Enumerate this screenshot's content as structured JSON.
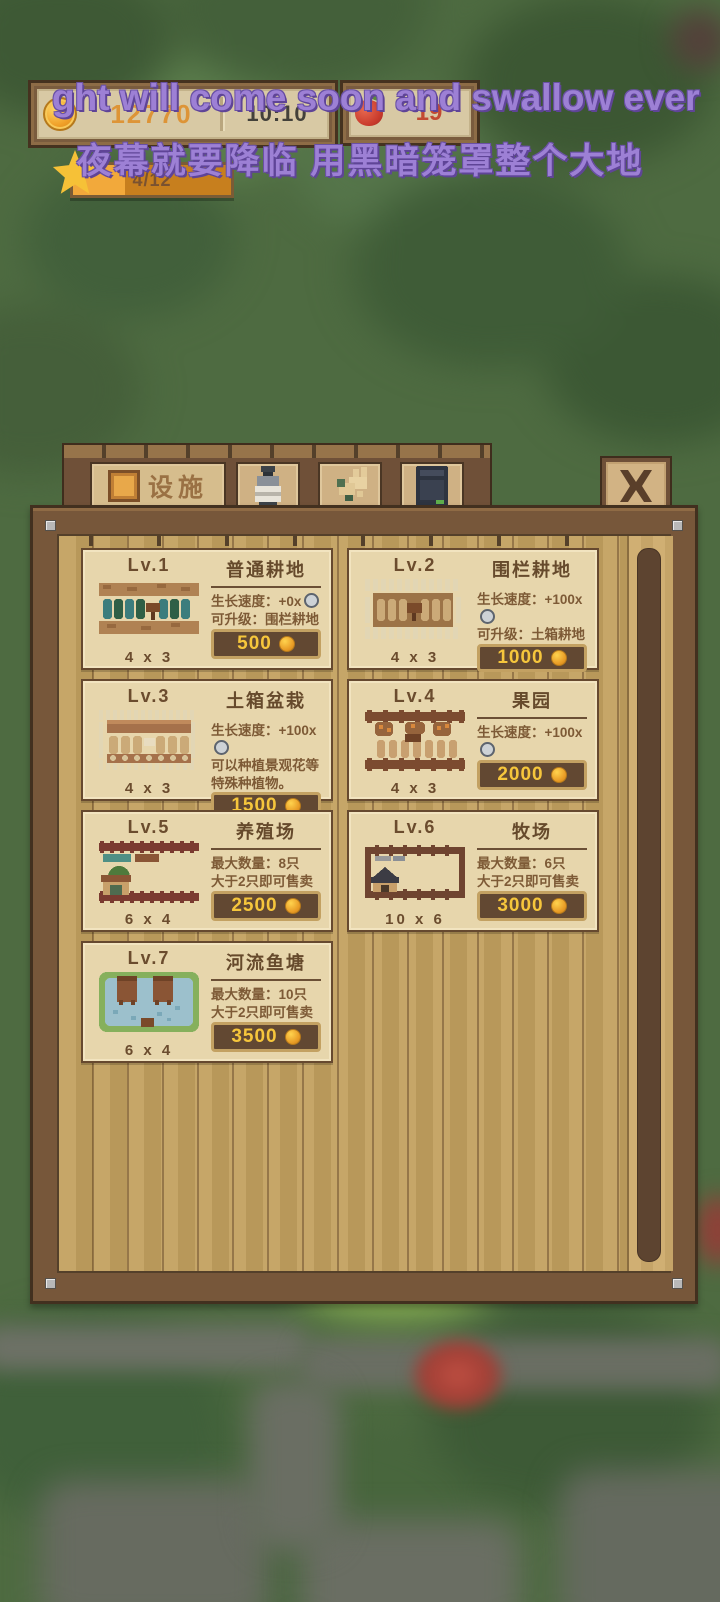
{
  "colors": {
    "coin_text": "#dd9437",
    "time_text": "#43413a",
    "apple_count_text": "#c24a32",
    "overlay_text": "#9d80d5",
    "price_text": "#f6c63c",
    "panel_wood": "#77573a",
    "card_background": "#e7d6ac",
    "tab_label": "#9a7144",
    "star_bar_fill": "#f2a93b"
  },
  "overlay": {
    "line1": "ght will come soon and swallow ever",
    "line2": "夜幕就要降临 用黑暗笼罩整个大地"
  },
  "hud": {
    "coins": "12770",
    "time": "10:10",
    "apple_count": "19",
    "star": {
      "label": "4/12",
      "fraction": 0.33
    }
  },
  "tab_bar": {
    "active_tab": {
      "label": "设施",
      "icon": "plot-icon"
    },
    "icon_tabs": [
      {
        "icon": "jar-icon"
      },
      {
        "icon": "animal-icon"
      },
      {
        "icon": "oven-icon"
      }
    ],
    "close_icon": "close-icon"
  },
  "shop": {
    "cards": [
      {
        "level": "Lv.1",
        "title": "普通耕地",
        "stats": [
          {
            "text": "生长速度：+0x",
            "clock": true
          },
          {
            "text": "可升级：围栏耕地",
            "clock": false
          }
        ],
        "size": "4 x 3",
        "price": "500",
        "image": "farmland"
      },
      {
        "level": "Lv.2",
        "title": "围栏耕地",
        "stats": [
          {
            "text": "生长速度：+100x",
            "clock": true
          },
          {
            "text": "可升级：土箱耕地",
            "clock": false
          }
        ],
        "size": "4 x 3",
        "price": "1000",
        "image": "fenced"
      },
      {
        "level": "Lv.3",
        "title": "土箱盆栽",
        "stats": [
          {
            "text": "生长速度：+100x",
            "clock": true
          },
          {
            "text": "可以种植景观花等特殊种植物。",
            "clock": false
          }
        ],
        "size": "4 x 3",
        "price": "1500",
        "image": "planter"
      },
      {
        "level": "Lv.4",
        "title": "果园",
        "stats": [
          {
            "text": "生长速度：+100x",
            "clock": true
          }
        ],
        "size": "4 x 3",
        "price": "2000",
        "image": "orchard"
      },
      {
        "level": "Lv.5",
        "title": "养殖场",
        "stats": [
          {
            "text": "最大数量：8只",
            "clock": false
          },
          {
            "text": "大于2只即可售卖",
            "clock": false
          }
        ],
        "size": "6 x 4",
        "price": "2500",
        "image": "ranch_small"
      },
      {
        "level": "Lv.6",
        "title": "牧场",
        "stats": [
          {
            "text": "最大数量：6只",
            "clock": false
          },
          {
            "text": "大于2只即可售卖",
            "clock": false
          }
        ],
        "size": "10 x 6",
        "price": "3000",
        "image": "ranch_big"
      },
      {
        "level": "Lv.7",
        "title": "河流鱼塘",
        "stats": [
          {
            "text": "最大数量：10只",
            "clock": false
          },
          {
            "text": "大于2只即可售卖",
            "clock": false
          }
        ],
        "size": "6 x 4",
        "price": "3500",
        "image": "pond"
      }
    ]
  }
}
